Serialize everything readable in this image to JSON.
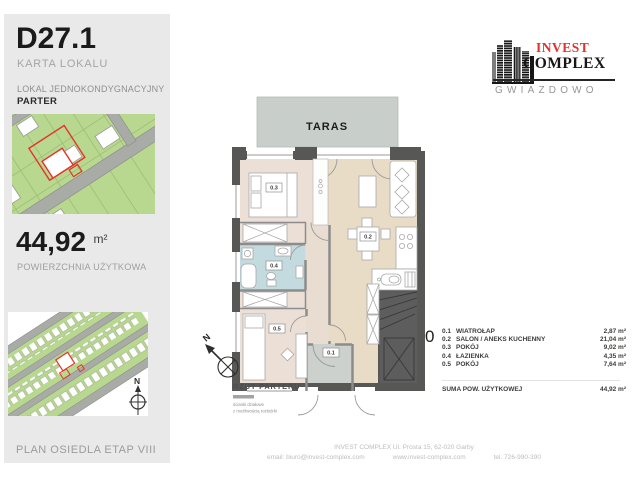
{
  "sidebar": {
    "unit_id": "D27.1",
    "subtitle": "KARTA LOKALU",
    "type_line1": "LOKAL JEDNOKONDYGNACYJNY",
    "type_line2": "PARTER",
    "area_value": "44,92",
    "area_unit": "m²",
    "area_label": "POWIERZCHNIA UŻYTKOWA",
    "bottom_label": "PLAN OSIEDLA ETAP VIII",
    "north": "N"
  },
  "logo": {
    "brand_line1": "INVEST",
    "brand_line2": "COMPLEX",
    "location": "GWIAZDOWO"
  },
  "floorplan": {
    "terrace_label": "TARAS",
    "caption": "RZUT PARTERU",
    "note_line1": "ścianki działowe",
    "note_line2": "z możliwością rozbiórki",
    "north": "N",
    "room_labels": {
      "r01": "0.1",
      "r02": "0.2",
      "r03": "0.3",
      "r04": "0.4",
      "r05": "0.5"
    }
  },
  "legend": {
    "floor_number": "0",
    "rooms": [
      {
        "no": "0.1",
        "name": "WIATROŁAP",
        "area": "2,87 m²"
      },
      {
        "no": "0.2",
        "name": "SALON / ANEKS KUCHENNY",
        "area": "21,04 m²"
      },
      {
        "no": "0.3",
        "name": "POKÓJ",
        "area": "9,02 m²"
      },
      {
        "no": "0.4",
        "name": "ŁAZIENKA",
        "area": "4,35 m²"
      },
      {
        "no": "0.5",
        "name": "POKÓJ",
        "area": "7,64 m²"
      }
    ],
    "total_label": "SUMA POW. UŻYTKOWEJ",
    "total_area": "44,92 m²"
  },
  "footer": {
    "line1": "INVEST COMPLEX Ul. Prosta 15, 62-020 Garby",
    "email": "email: biuro@invest-complex.com",
    "www": "www.invest-complex.com",
    "tel": "tel. 726-990-390"
  },
  "colors": {
    "accent_red": "#e5332a",
    "brand_red": "#e3312b",
    "map_green": "#b7d88e",
    "terrace_gray": "#c8cec9",
    "wall_dark": "#575756",
    "bathroom_blue": "#c3dbdf",
    "floor_beige": "#e8dcc7",
    "sidebar_gray": "#e9e9e9"
  }
}
